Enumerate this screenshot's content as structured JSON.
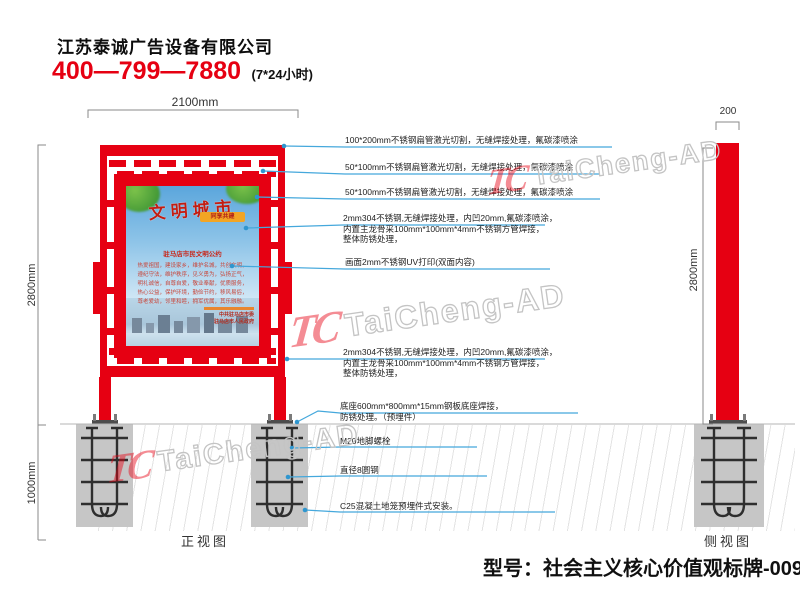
{
  "header": {
    "company": "江苏泰诚广告设备有限公司",
    "phone": "400—799—7880",
    "hours": "(7*24小时)"
  },
  "dimensions": {
    "front_width": "2100mm",
    "front_height": "2800mm",
    "foundation_depth": "1000mm",
    "side_width": "200",
    "side_height": "2800mm"
  },
  "annotations": [
    [
      "100*200mm不锈钢扁管激光切割，无缝焊接处理，氟碳漆喷涂"
    ],
    [
      "50*100mm不锈钢扁管激光切割，无缝焊接处理，氟碳漆喷涂"
    ],
    [
      "50*100mm不锈钢扁管激光切割，无缝焊接处理，氟碳漆喷涂"
    ],
    [
      "2mm304不锈钢,无缝焊接处理，内凹20mm,氟碳漆喷涂，",
      "内置主龙骨采100mm*100mm*4mm不锈钢方管焊接，",
      "整体防锈处理，"
    ],
    [
      "画面2mm不锈钢UV打印(双面内容)"
    ],
    [
      "2mm304不锈钢,无缝焊接处理，内凹20mm,氟碳漆喷涂，",
      "内置主龙骨采100mm*100mm*4mm不锈钢方管焊接，",
      "整体防锈处理，"
    ],
    [
      "底座600mm*800mm*15mm钢板底座焊接，",
      "防锈处理。（预埋件）"
    ],
    [
      "M20地脚螺栓"
    ],
    [
      "直径8圆钢"
    ],
    [
      "C25混凝土地笼预埋件式安装。"
    ]
  ],
  "views": {
    "front_label": "正视图",
    "side_label": "侧视图"
  },
  "poster": {
    "title": "文明城市",
    "badge": "同享共建",
    "heading": "驻马店市民文明公约",
    "body_lines": [
      "热爱祖国，建设家乡，维护名城，共创文明，",
      "遵纪守法，维护秩序，见义勇为，弘扬正气，",
      "明礼诚信，自尊自爱，敬业奉献，优质服务，",
      "热心公益，保护环境，勤俭节约，移风易俗，",
      "尊老爱幼，邻里和睦，拥军优属，其乐融融。"
    ],
    "footer_lines": [
      "中共驻马店市委",
      "驻马店市人民政府"
    ]
  },
  "watermark": {
    "logo": "TC",
    "text": "TaiCheng-AD"
  },
  "model_label": "型号：社会主义核心价值观标牌-0098",
  "colors": {
    "accent_red": "#e60012",
    "leader_blue": "#45a8dc",
    "concrete_gray": "#c6c6c6"
  }
}
